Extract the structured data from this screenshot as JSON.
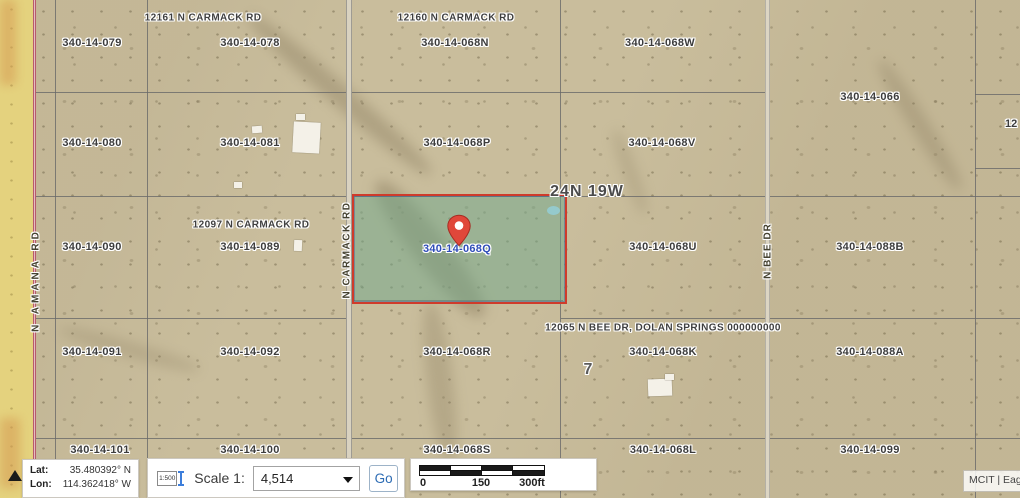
{
  "map": {
    "township_label": "24N 19W",
    "section_number": "7",
    "edge_partial_label": "12",
    "highlighted_parcel_label": "340-14-068Q",
    "parcel_labels": [
      {
        "label": "340-14-079",
        "x": 92,
        "y": 43
      },
      {
        "label": "340-14-078",
        "x": 250,
        "y": 43
      },
      {
        "label": "340-14-068N",
        "x": 455,
        "y": 43
      },
      {
        "label": "340-14-068W",
        "x": 660,
        "y": 43
      },
      {
        "label": "340-14-066",
        "x": 870,
        "y": 97
      },
      {
        "label": "340-14-080",
        "x": 92,
        "y": 143
      },
      {
        "label": "340-14-081",
        "x": 250,
        "y": 143
      },
      {
        "label": "340-14-068P",
        "x": 457,
        "y": 143
      },
      {
        "label": "340-14-068V",
        "x": 662,
        "y": 143
      },
      {
        "label": "340-14-090",
        "x": 92,
        "y": 247
      },
      {
        "label": "340-14-089",
        "x": 250,
        "y": 247
      },
      {
        "label": "340-14-068Q",
        "x": 457,
        "y": 249,
        "highlighted": true
      },
      {
        "label": "340-14-068U",
        "x": 663,
        "y": 247
      },
      {
        "label": "340-14-088B",
        "x": 870,
        "y": 247
      },
      {
        "label": "340-14-091",
        "x": 92,
        "y": 352
      },
      {
        "label": "340-14-092",
        "x": 250,
        "y": 352
      },
      {
        "label": "340-14-068R",
        "x": 457,
        "y": 352
      },
      {
        "label": "340-14-068K",
        "x": 663,
        "y": 352
      },
      {
        "label": "340-14-088A",
        "x": 870,
        "y": 352
      },
      {
        "label": "340-14-101",
        "x": 100,
        "y": 450
      },
      {
        "label": "340-14-100",
        "x": 250,
        "y": 450
      },
      {
        "label": "340-14-068S",
        "x": 457,
        "y": 450
      },
      {
        "label": "340-14-068L",
        "x": 663,
        "y": 450
      },
      {
        "label": "340-14-099",
        "x": 870,
        "y": 450
      }
    ],
    "address_labels": [
      {
        "text": "12161 N CARMACK RD",
        "x": 203,
        "y": 18
      },
      {
        "text": "12160 N CARMACK RD",
        "x": 456,
        "y": 18
      },
      {
        "text": "12097 N CARMACK RD",
        "x": 251,
        "y": 225
      },
      {
        "text": "12065 N BEE DR, DOLAN SPRINGS 000000000",
        "x": 663,
        "y": 328
      }
    ],
    "road_labels": [
      {
        "name": "N AMANA RD",
        "x": 36,
        "y": 280
      },
      {
        "name": "N CARMACK RD",
        "x": 347,
        "y": 250
      },
      {
        "name": "N BEE DR",
        "x": 768,
        "y": 251
      }
    ],
    "colors": {
      "highlight_fill": "#6ea88b",
      "highlight_border": "#cf3b2b",
      "highlight_label_blue": "#2f4db8",
      "pin_red": "#e0473a"
    },
    "icons": {
      "location_pin": "map-pin",
      "collapse": "triangle-up",
      "dropdown": "caret-down",
      "scale_tool": "text-cursor"
    }
  },
  "toolbar": {
    "lat_label": "Lat:",
    "lat_value": "35.480392° N",
    "lon_label": "Lon:",
    "lon_value": "114.362418° W",
    "scale_icon_text": "1:500",
    "scale_label": "Scale 1:",
    "scale_value": "4,514",
    "go_label": "Go",
    "scalebar": {
      "start": "0",
      "mid": "150",
      "end": "300ft"
    }
  },
  "attribution": {
    "text": "MCIT | Eagle"
  }
}
